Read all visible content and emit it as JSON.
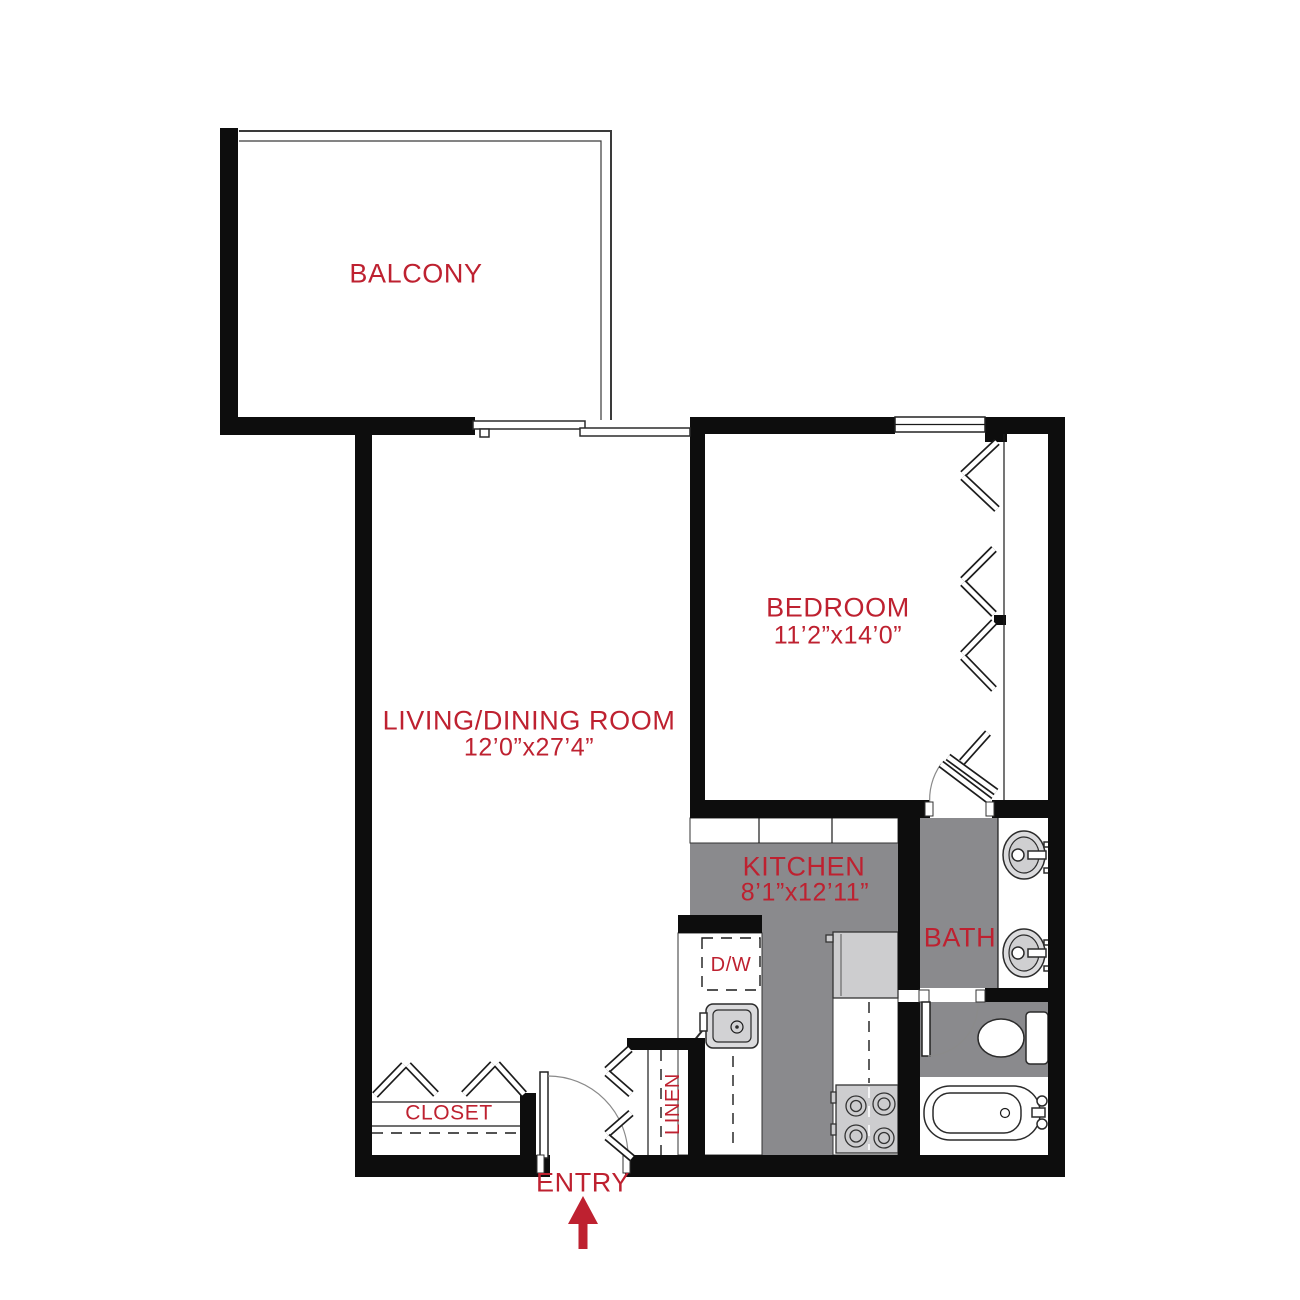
{
  "colors": {
    "accent": "#BE2130",
    "wall": "#0d0d0d",
    "floor": "#8a8a8d",
    "appliance": "#cdcdcf",
    "fixture": "#dbdbdd",
    "line": "#1a1a1a"
  },
  "rooms": {
    "balcony": {
      "label": "BALCONY"
    },
    "living_dining": {
      "label": "LIVING/DINING ROOM",
      "dimensions": "12’0”x27’4”"
    },
    "bedroom": {
      "label": "BEDROOM",
      "dimensions": "11’2”x14’0”"
    },
    "kitchen": {
      "label": "KITCHEN",
      "dimensions": "8’1”x12’11”"
    },
    "bath": {
      "label": "BATH"
    },
    "closet": {
      "label": "CLOSET"
    },
    "linen": {
      "label": "LINEN"
    },
    "entry": {
      "label": "ENTRY"
    }
  },
  "appliances": {
    "dishwasher_label": "D/W"
  }
}
